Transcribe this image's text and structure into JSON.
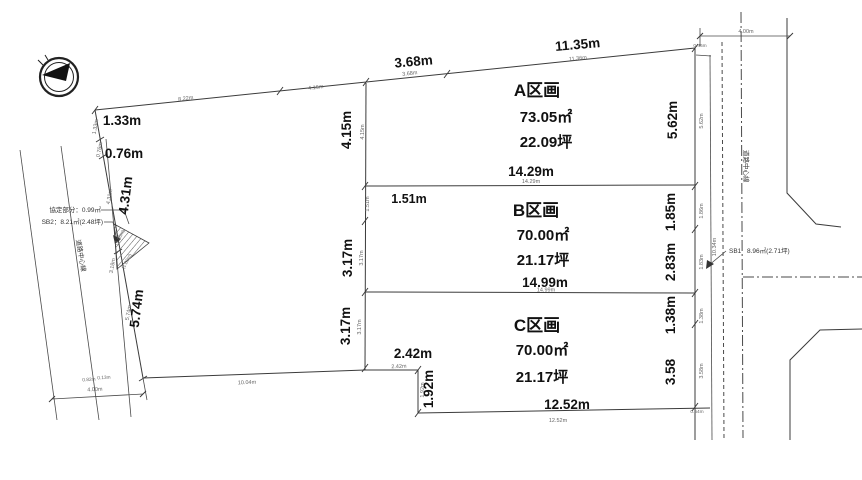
{
  "colors": {
    "background": "#ffffff",
    "line": "#3b3b3b",
    "bold_text": "#111111",
    "small_text": "#666666"
  },
  "compass": {
    "icon": "north-arrow"
  },
  "parcels": [
    {
      "name": "A区画",
      "area_m2": "73.05㎡",
      "area_tsubo": "22.09坪",
      "frontage": "14.29m",
      "frontage_small": "14.29m"
    },
    {
      "name": "B区画",
      "area_m2": "70.00㎡",
      "area_tsubo": "21.17坪",
      "frontage": "14.99m",
      "frontage_small": "14.99m"
    },
    {
      "name": "C区画",
      "area_m2": "70.00㎡",
      "area_tsubo": "21.17坪",
      "frontage": "12.52m",
      "frontage_small": "12.52m"
    }
  ],
  "top_boundary": {
    "seg_small": [
      "8.22m",
      "4.16m",
      "3.68m",
      "11.36m"
    ],
    "seg_bold_3": "3.68m",
    "seg_bold_4": "11.35m"
  },
  "west_boundary": {
    "bold": [
      "1.33m",
      "0.76m",
      "4.31m",
      "5.74m"
    ],
    "small": [
      "1.33m",
      "0.76m",
      "4.31m",
      "3.18m",
      "5.74m"
    ],
    "corner_small": [
      "0.82m",
      "0.13m"
    ],
    "bottom_edge_small": "10.04m"
  },
  "inner_edge": {
    "a_left_bold": "4.15m",
    "a_left_small": "4.15m",
    "b_left1_bold": "1.51m",
    "b_left1_small": "1.51m",
    "b_left2_bold": "3.17m",
    "b_left2_small": "3.17m",
    "c_left_bold": "3.17m",
    "c_left_small": "3.17m",
    "c_step_h_bold": "2.42m",
    "c_step_h_small": "2.42m",
    "c_step_v_bold": "1.92m",
    "c_step_v_small": "1.92m"
  },
  "east_boundary": {
    "bold": [
      "5.62m",
      "1.85m",
      "2.83m",
      "1.38m",
      "3.58"
    ],
    "small": [
      "0.46m",
      "5.62m",
      "1.86m",
      "10.34m",
      "1.83m",
      "1.38m",
      "3.58m",
      "0.54m"
    ]
  },
  "roads": {
    "west_width": "4.00m",
    "east_width": "4.00m",
    "west_centerline": "道路中心線",
    "east_centerline": "道路中心線"
  },
  "annotations": {
    "kyotei": "協定部分：0.99㎡",
    "sb2": "SB2：8.21㎡(2.48坪)",
    "sb1_tag": "SB1",
    "sb1_area": "8.96㎡(2.71坪)",
    "one_m_a": "(1.00m)",
    "one_m_b": "(1.00m)"
  }
}
